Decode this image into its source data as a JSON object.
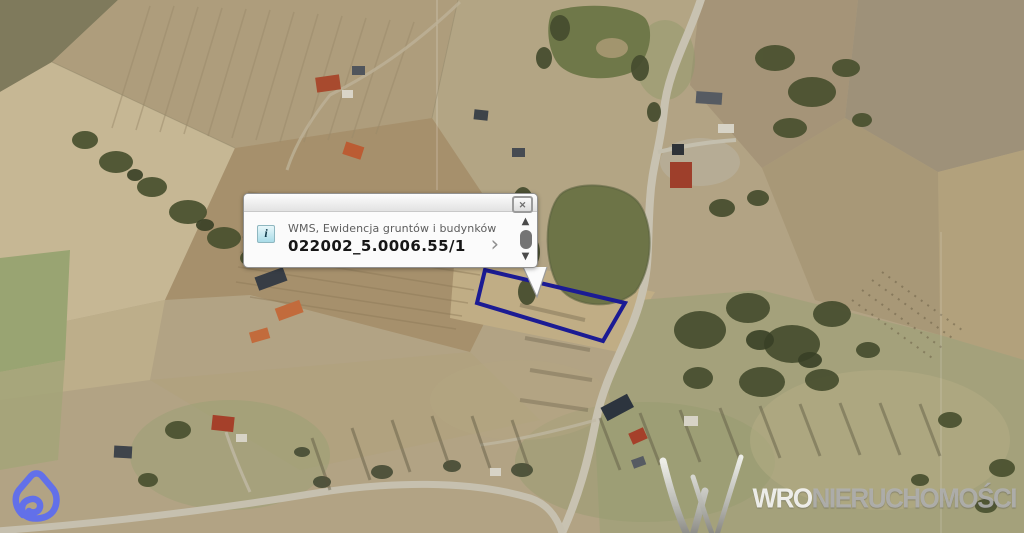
{
  "popup": {
    "header": {
      "close_icon": "✕"
    },
    "row": {
      "info_icon": "i",
      "wms_label": "WMS, Ewidencja gruntów i budynków",
      "parcel_id": "022002_5.0006.55/1",
      "chevron_icon": "›"
    },
    "scrollbar": {
      "up_icon": "▲",
      "down_icon": "▼"
    }
  },
  "watermark": {
    "prefix": "WRO",
    "suffix": "NIERUCHOMOŚCI"
  },
  "map": {
    "parcel_outline_color": "#1b1b94",
    "brand_color": "#5b6bf2",
    "info_icon_bg": "#a9dce8",
    "pond_color": "#6d7447",
    "road_color": "#c8c2b1"
  }
}
